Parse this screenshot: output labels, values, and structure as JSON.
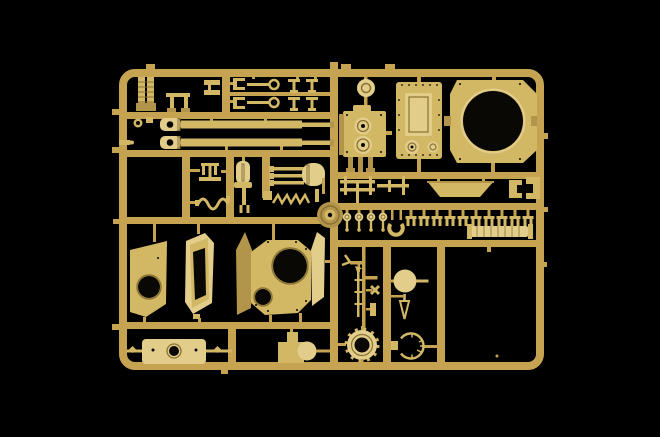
{
  "scene": {
    "description": "Photograph of a tan plastic model-kit sprue (injection-moulded parts tree) with tank model parts, lit against a pure black background",
    "subject": "model kit sprue with tank parts",
    "plastic_color_name": "sand tan",
    "background_name": "black"
  },
  "colors": {
    "background": "#000000",
    "runner": "#c6a350",
    "part": "#d2b765",
    "part_bright": "#e2cd8b",
    "part_dim": "#b2944a",
    "hole": "#0a0805",
    "line": "#8a7233"
  },
  "parts": {
    "labels": [
      "sprue-frame",
      "gun-barrel-a",
      "gun-barrel-b",
      "muzzle-brake",
      "segmented-posts",
      "tow-shackle-rods",
      "t-pins",
      "fuel-filler-cap",
      "engine-block",
      "rear-hatch-plate",
      "turret-ring-plate",
      "mud-flap",
      "rail-brackets",
      "clip-brackets",
      "suspension-clips-row",
      "wheel-hub-caps",
      "horseshoe-clamp",
      "ribbed-roller",
      "idler-wheel",
      "turret-side-plate",
      "hatch-frame",
      "turret-shell",
      "recoil-cylinder",
      "stepped-bracket",
      "toothed-hub-ring",
      "ball-mount",
      "aerial-rod",
      "open-ring-gauge",
      "periscope",
      "tube-cluster",
      "sawtooth-strip",
      "wavy-spring",
      "trident-bracket"
    ],
    "count_visible_cells": 12
  }
}
